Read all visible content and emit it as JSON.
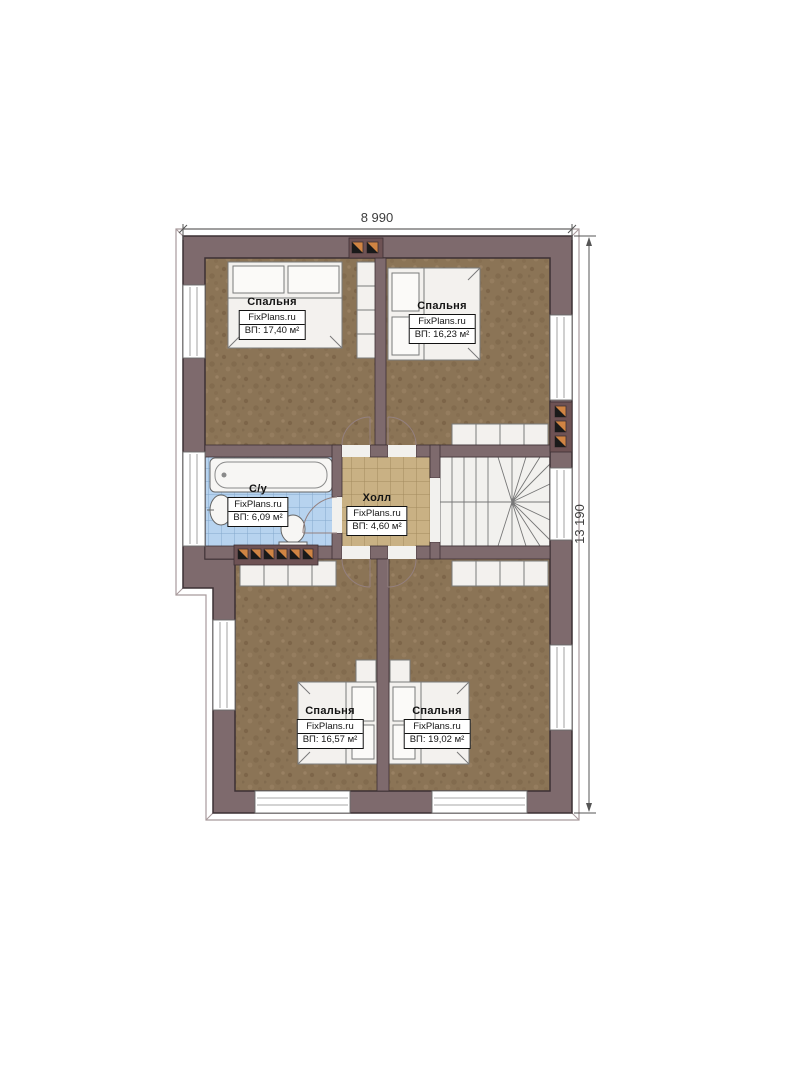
{
  "plan": {
    "title": "floor-plan-second-level",
    "background": "#ffffff"
  },
  "dimensions": {
    "width_label": "8 990",
    "height_label": "13 190"
  },
  "rooms": [
    {
      "id": "bedroom-top-left",
      "name": "Спальня",
      "brand": "FixPlans.ru",
      "area": "ВП: 17,40 м²"
    },
    {
      "id": "bedroom-top-right",
      "name": "Спальня",
      "brand": "FixPlans.ru",
      "area": "ВП: 16,23 м²"
    },
    {
      "id": "bathroom",
      "name": "С/у",
      "brand": "FixPlans.ru",
      "area": "ВП: 6,09 м²"
    },
    {
      "id": "hall",
      "name": "Холл",
      "brand": "FixPlans.ru",
      "area": "ВП: 4,60 м²"
    },
    {
      "id": "bedroom-bottom-left",
      "name": "Спальня",
      "brand": "FixPlans.ru",
      "area": "ВП: 16,57 м²"
    },
    {
      "id": "bedroom-bottom-right",
      "name": "Спальня",
      "brand": "FixPlans.ru",
      "area": "ВП: 19,02 м²"
    }
  ],
  "fixtures": [
    "bed",
    "wardrobe",
    "bathtub",
    "sink",
    "toilet",
    "winder-stairs",
    "vent-block",
    "window",
    "door-swing"
  ],
  "colors": {
    "wall": "#7e6a6d",
    "wall_outline": "#3c3034",
    "bedroom_floor": "#8b7456",
    "bath_tile": "#b7d3ef",
    "hall_tile": "#c9b184",
    "stairs": "#f2f1ee",
    "furniture": "#f3f1ee",
    "vent_orange": "#d08443",
    "dimension_text": "#3d3d3d"
  }
}
